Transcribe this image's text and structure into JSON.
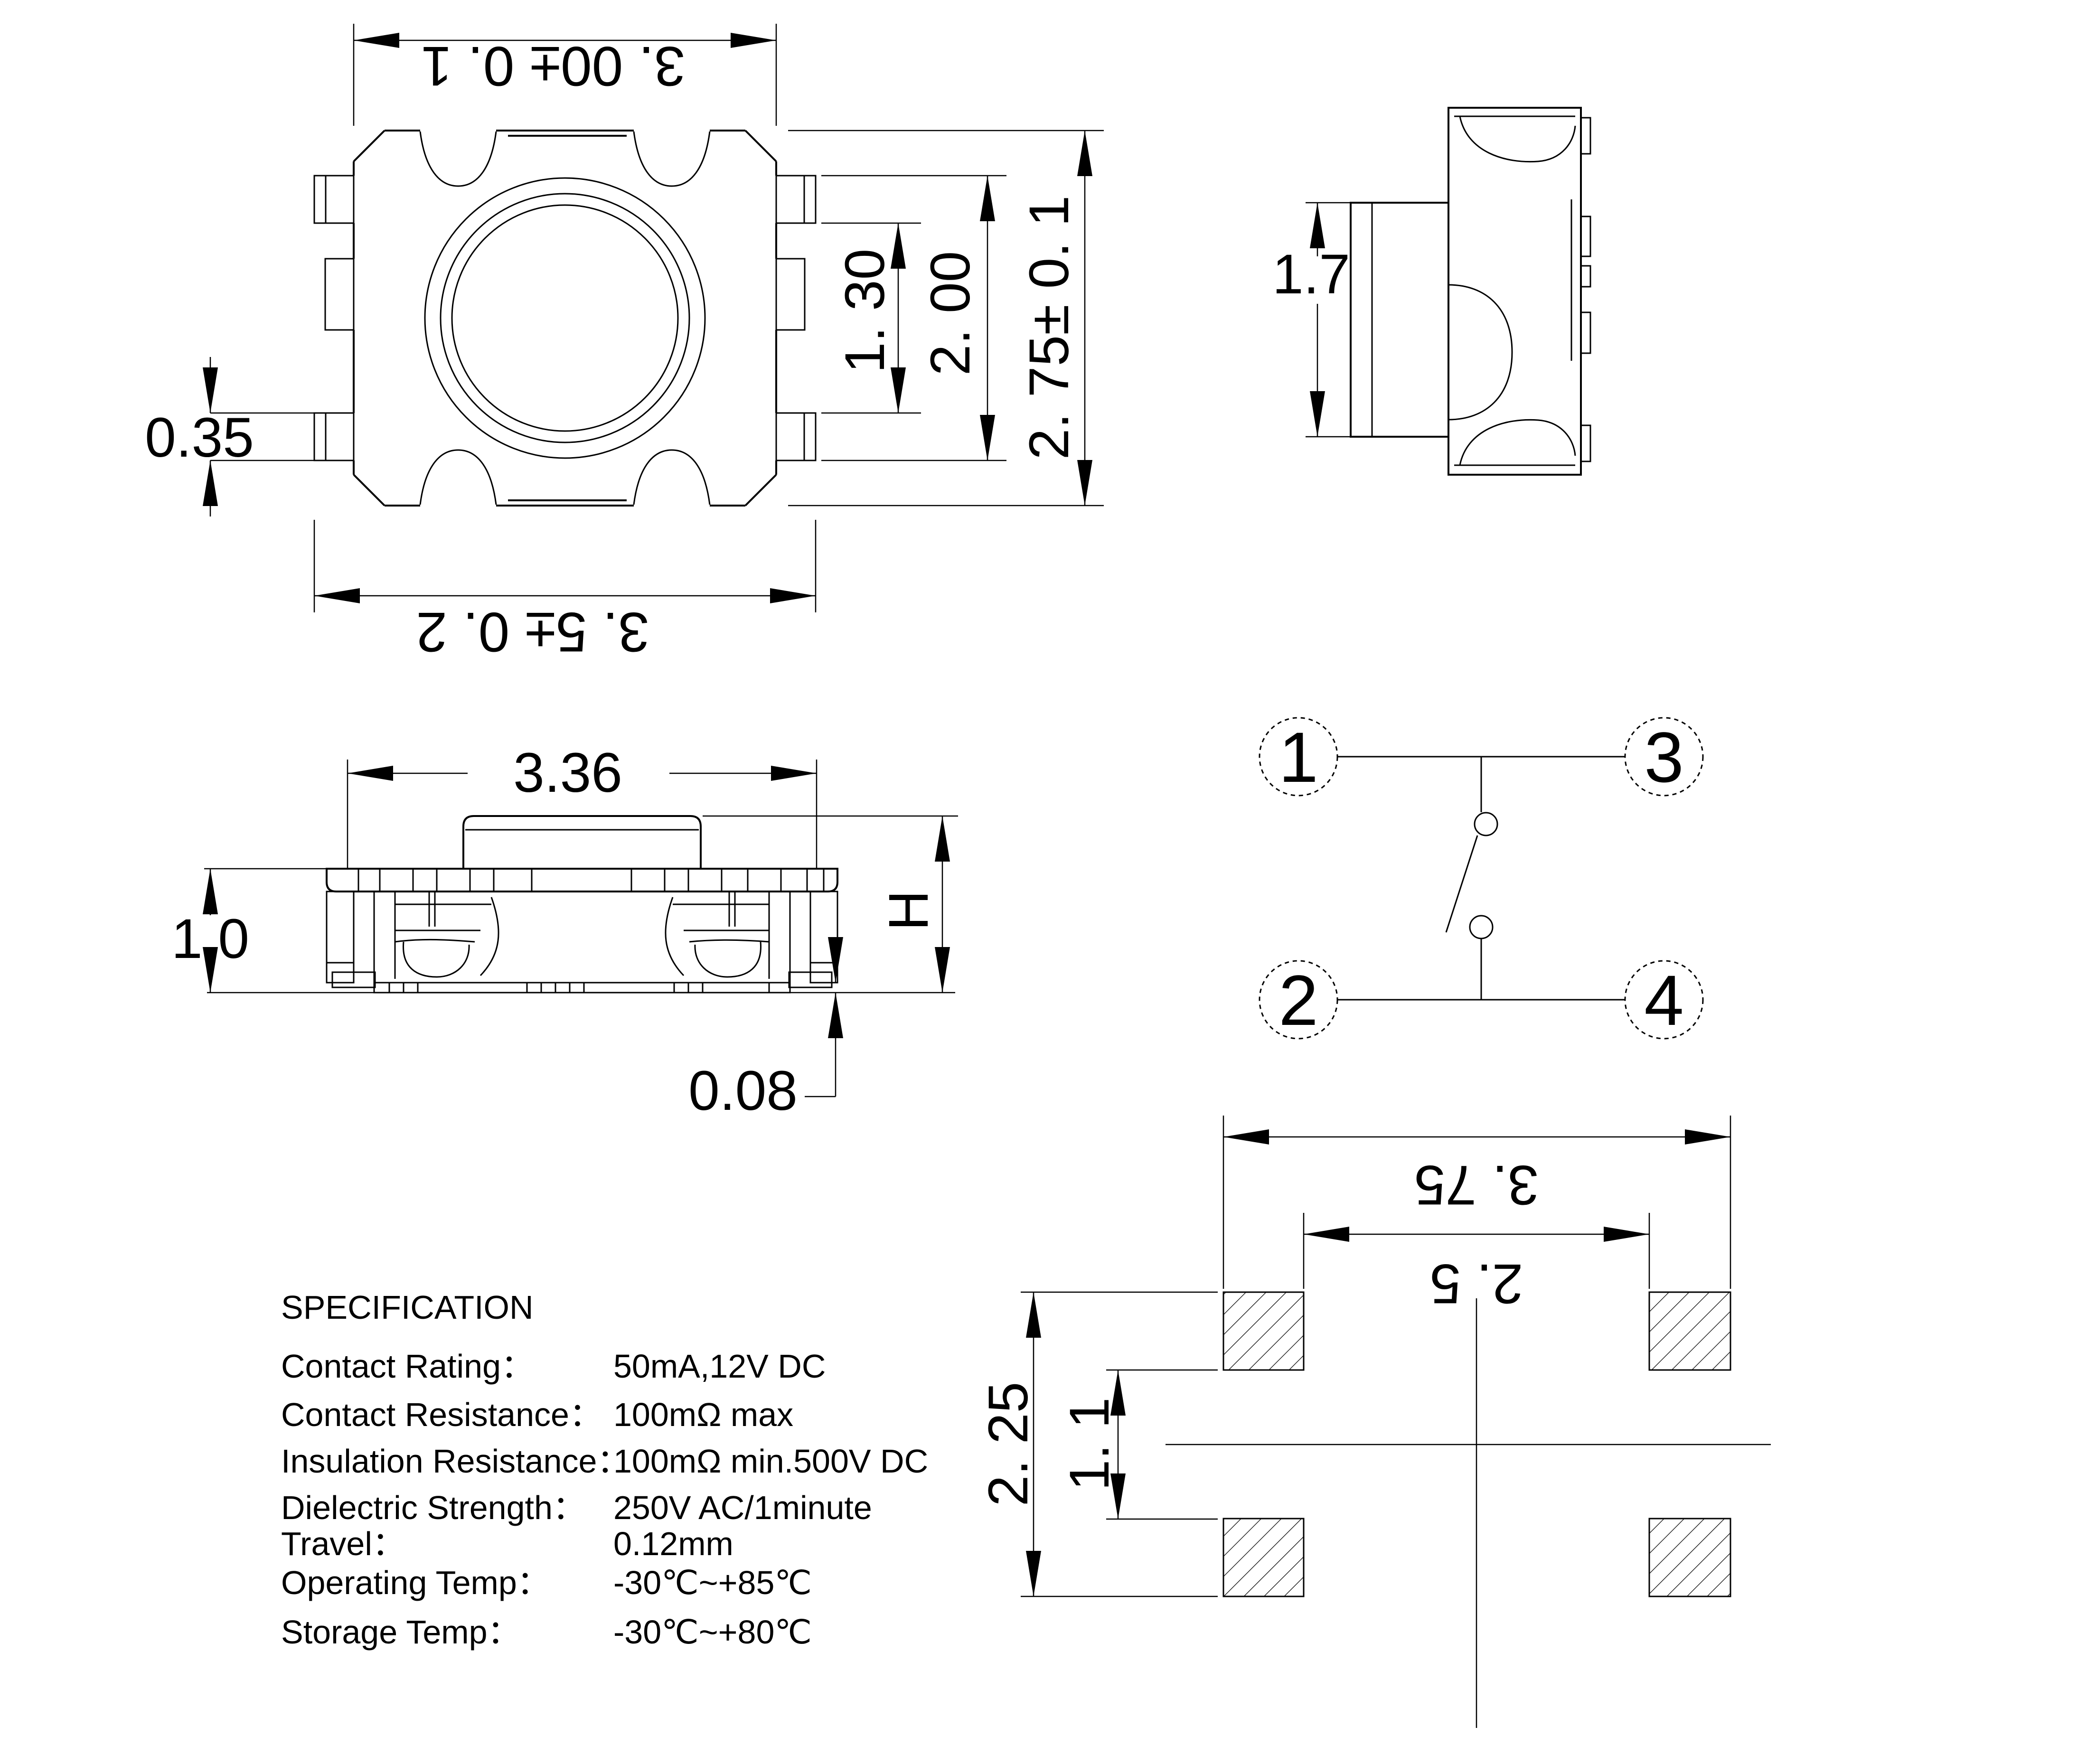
{
  "page": {
    "background": "#ffffff",
    "ink": "#000000"
  },
  "dimensions": {
    "body_width": "3. 00± 0. 1",
    "overall_width": "3. 5± 0. 2",
    "contact_inner_span": "1. 30",
    "contact_outer_span": "2. 00",
    "body_depth": "2. 75± 0. 1",
    "tab_width": "0.35",
    "stem_diameter": "1.7",
    "base_width": "3.36",
    "base_height": "1.0",
    "overall_height": "H",
    "foot_thickness": "0.08",
    "pad_outer_span": "3. 75",
    "pad_inner_span": "2. 5",
    "pad_outer_height": "2. 25",
    "pad_inner_height": "1. 1"
  },
  "schematic": {
    "terminals": [
      "1",
      "3",
      "2",
      "4"
    ]
  },
  "specification": {
    "title": "SPECIFICATION",
    "rows": [
      {
        "label": "Contact Rating：",
        "value": "50mA,12V DC"
      },
      {
        "label": "Contact Resistance：",
        "value": "100mΩ max"
      },
      {
        "label": "Insulation Resistance：",
        "value": "100mΩ min.500V DC"
      },
      {
        "label": "Dielectric Strength：",
        "value": "250V AC/1minute"
      },
      {
        "label": "Travel：",
        "value": "0.12mm"
      },
      {
        "label": "Operating Temp：",
        "value": "-30℃~+85℃"
      },
      {
        "label": "Storage Temp：",
        "value": "-30℃~+80℃"
      }
    ]
  }
}
